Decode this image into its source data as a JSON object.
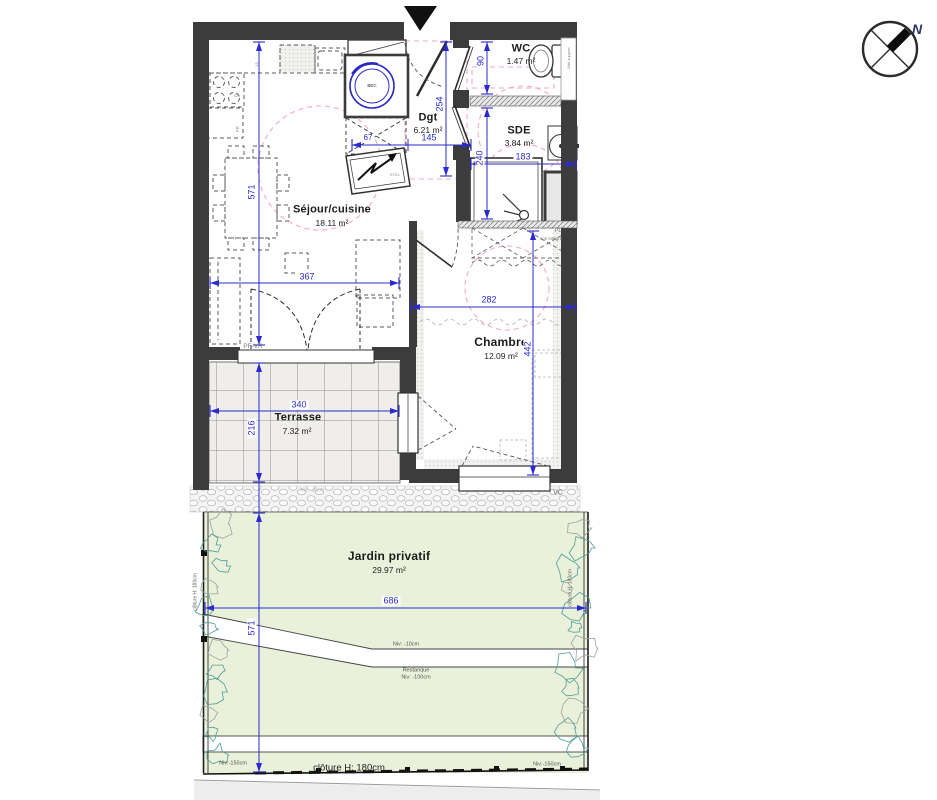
{
  "plan": {
    "rooms": {
      "wc": {
        "name": "WC",
        "area": "1.47 m²"
      },
      "dgt": {
        "name": "Dgt",
        "area": "6.21 m²"
      },
      "sde": {
        "name": "SDE",
        "area": "3.84 m²"
      },
      "sejour": {
        "name": "Séjour/cuisine",
        "area": "18.11 m²"
      },
      "chambre": {
        "name": "Chambre",
        "area": "12.09 m²"
      },
      "terrasse": {
        "name": "Terrasse",
        "area": "7.32 m²"
      },
      "jardin": {
        "name": "Jardin privatif",
        "area": "29.97 m²"
      }
    },
    "dims": {
      "sejour_h": "571",
      "sejour_w": "367",
      "terrasse_h": "216",
      "terrasse_w": "340",
      "dgt_h": "254",
      "dgt_w": "145",
      "placard_w": "67",
      "wc_h": "90",
      "sde_h": "240",
      "sde_w": "183",
      "chambre_w": "282",
      "chambre_h": "442",
      "jardin_w": "686",
      "jardin_h": "571"
    },
    "annotations": {
      "pf_vr": "PF-VR",
      "pl": "PL",
      "pl_sub": "non intégré",
      "bati_support": "Bâti support",
      "bec": "BEC",
      "etel": "ETEL",
      "vc": "VC",
      "ll": "LL",
      "cu": "Cu",
      "fr": "FR",
      "niv_terrasse": "Niv: -10cm",
      "niv_jardin": "Niv: -10cm",
      "restanque": "Restanque",
      "niv_restanque": "Niv: -100cm",
      "niv_left": "Niv:-150cm",
      "niv_right": "Niv:-150cm",
      "cloture": "clôture H: 180cm",
      "cloture_left": "clôture H: 180cm",
      "cloture_right": "clôture H: 180cm"
    },
    "compass": {
      "north": "N"
    },
    "colors": {
      "wall": "#3c3c3c",
      "dim_blue": "#2a2ad0",
      "accessibility_pink": "#f2aabb",
      "garden_green": "#eaf1da",
      "tile_grey": "#efeeea"
    }
  }
}
